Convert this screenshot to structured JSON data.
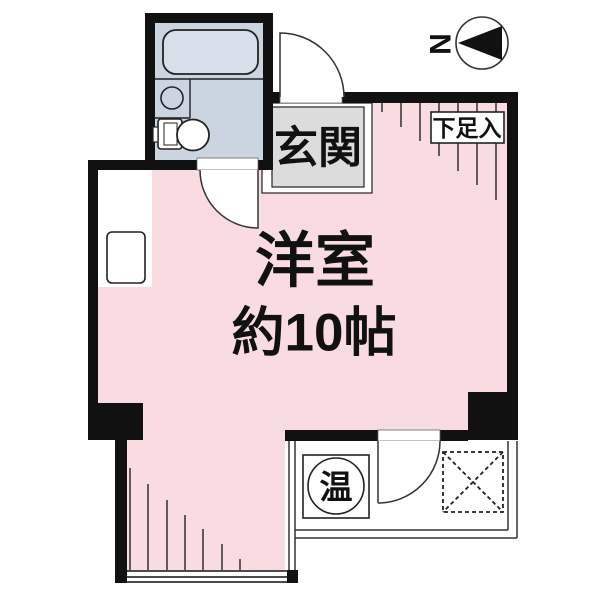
{
  "document": {
    "kind": "Japanese apartment floor plan"
  },
  "colors": {
    "wall": "#111111",
    "room_pink": "#f9dce1",
    "bath_floor": "#cad5e0",
    "bathtub_fill": "#d7e0e9",
    "entrance_gray": "#dcdcdc",
    "line_dark": "#1f1f1f",
    "white": "#ffffff"
  },
  "labels": {
    "entrance": "玄関",
    "shoe_storage": "下足入",
    "room_name": "洋室",
    "room_size": "約10帖",
    "water_heater": "温",
    "compass_north": "N"
  }
}
